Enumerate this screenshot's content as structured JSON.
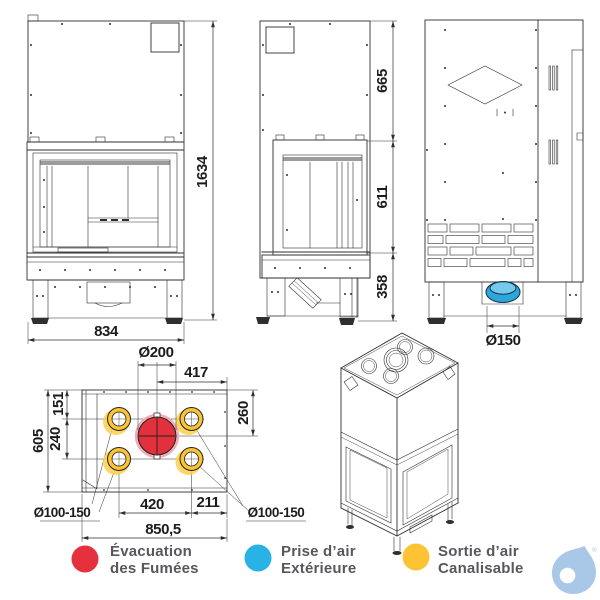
{
  "dimensions": {
    "front": {
      "height": "1634",
      "width": "834"
    },
    "side": {
      "hood": "665",
      "firebox": "611",
      "base": "358"
    },
    "back": {
      "air_inlet": "Ø150"
    },
    "top": {
      "flue": "Ø200",
      "flue_to_edge": "417",
      "edge_to_outlet_row": "151",
      "outlet_rows_gap": "240",
      "depth": "605",
      "edge_to_flue": "260",
      "outlet_cols_gap": "420",
      "col_to_edge": "211",
      "width": "850,5",
      "outlets_left": "Ø100-150",
      "outlets_right": "Ø100-150"
    }
  },
  "legend": {
    "smoke": {
      "line1": "Évacuation",
      "line2": "des Fumées",
      "color": "#e5313d"
    },
    "air_intake": {
      "line1": "Prise d’air",
      "line2": "Extérieure",
      "color": "#29b2e5"
    },
    "air_duct": {
      "line1": "Sortie d’air",
      "line2": "Canalisable",
      "color": "#fcc435"
    }
  },
  "colors": {
    "flue": "#e2303c",
    "flue_halo": "#f2a9b0",
    "outlet": "#fcc435",
    "outlet_glow": "#fdd04a",
    "inlet": "#2fa6da",
    "inlet_light": "#74c9ec",
    "logo": "#a9c8e7",
    "line": "#2f2f2f"
  },
  "logo": {
    "registered": "®"
  }
}
